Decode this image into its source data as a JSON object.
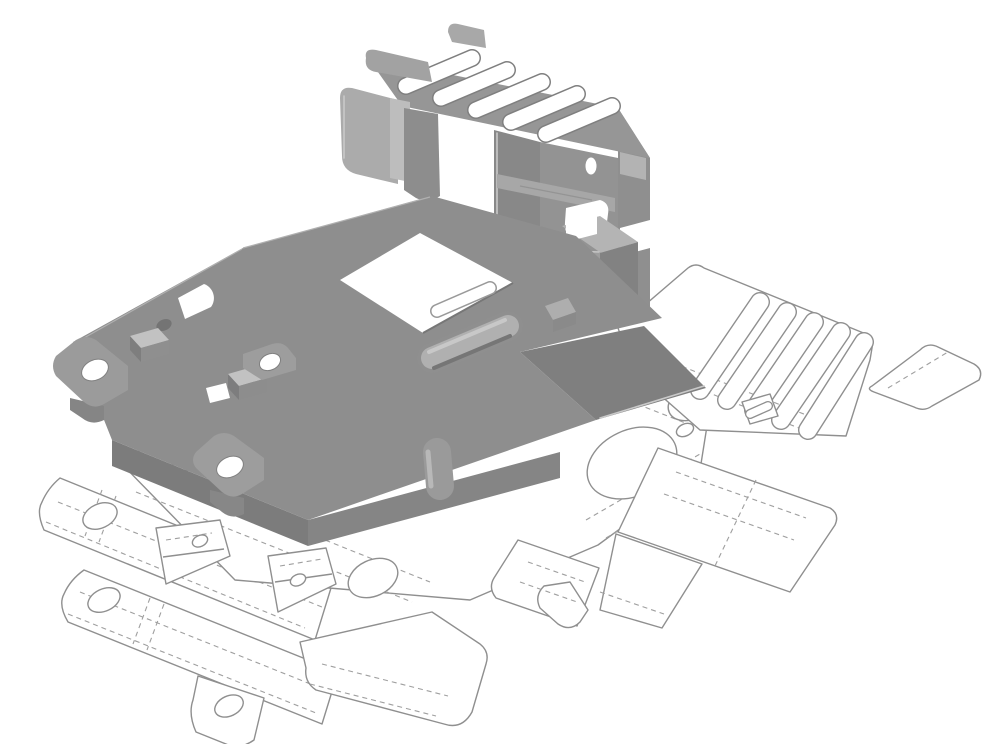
{
  "scene": {
    "type": "cad-illustration",
    "description": "Gray shaded isometric 3D view of a folded sheet-metal bracket shown above its unfolded flat-pattern outline drawing with dashed bend lines on a white background",
    "background": "#ffffff"
  },
  "colors": {
    "background": "#ffffff",
    "flat_outline": "#8f8f8f",
    "bend_line": "#9f9f9f",
    "plate_top": "#8e8e8e",
    "panel_top": "#969696",
    "wall_dark": "#7c7c7c",
    "wall_mid": "#8f8f8f",
    "face_light": "#b4b4b4",
    "flange_light": "#ababab",
    "highlight": "#c9c9c9",
    "hole_white": "#ffffff",
    "hole_shadow": "#747474"
  },
  "folded_part": {
    "name": "folded-sheet-metal-bracket",
    "vent_slot_count": 5,
    "mounting_ear_holes": 3,
    "rectangular_cutouts": 2,
    "render_style": "shaded gray, no outlines"
  },
  "flat_pattern": {
    "name": "flat-pattern-blank",
    "vent_slot_count": 5,
    "round_holes": 10,
    "tabs_with_holes": 3,
    "bend_line_style": "dashed",
    "render_style": "thin gray outline drawing"
  }
}
